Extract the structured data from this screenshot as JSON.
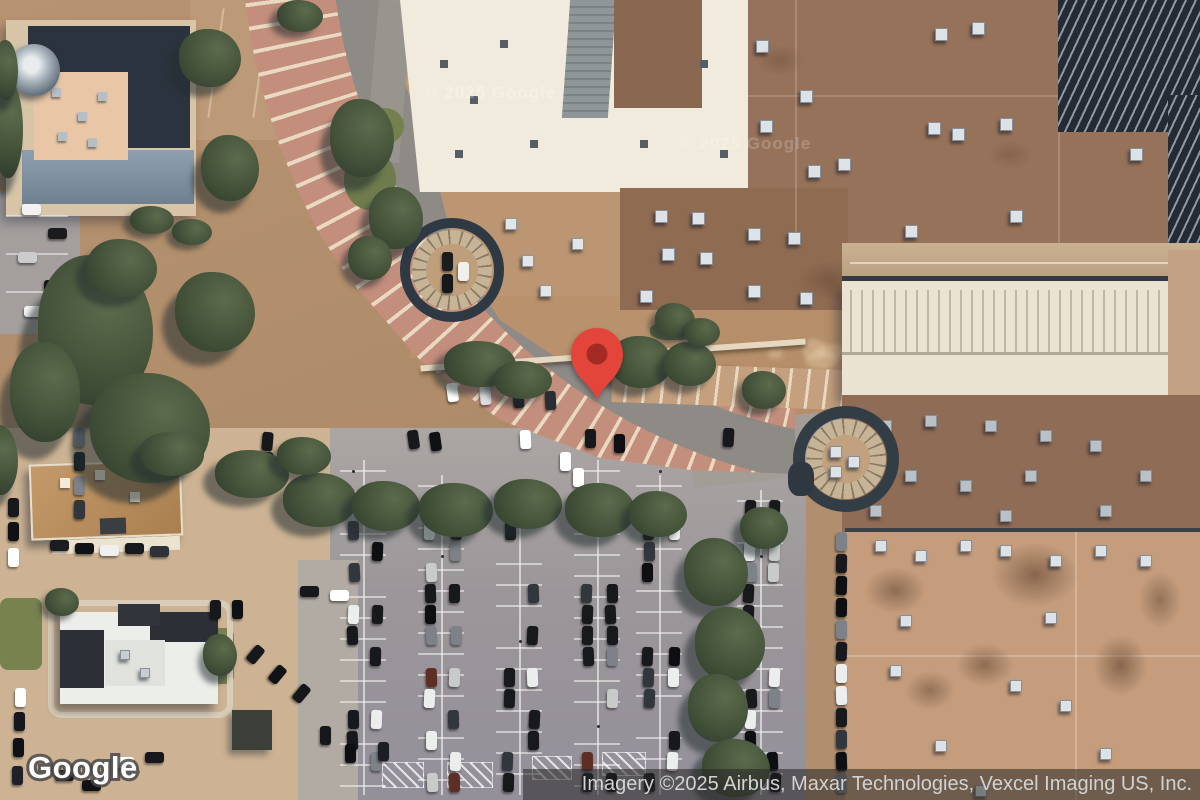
{
  "map_view": {
    "marker": {
      "fill": "#E3453B",
      "dot": "#A32B23"
    }
  },
  "branding": {
    "logo_text": "Google"
  },
  "watermarks": [
    {
      "text": "© 2025 Google"
    },
    {
      "text": "© 2025 Google"
    }
  ],
  "attribution": {
    "text": "Imagery ©2025 Airbus, Maxar Technologies, Vexcel Imaging US, Inc."
  }
}
